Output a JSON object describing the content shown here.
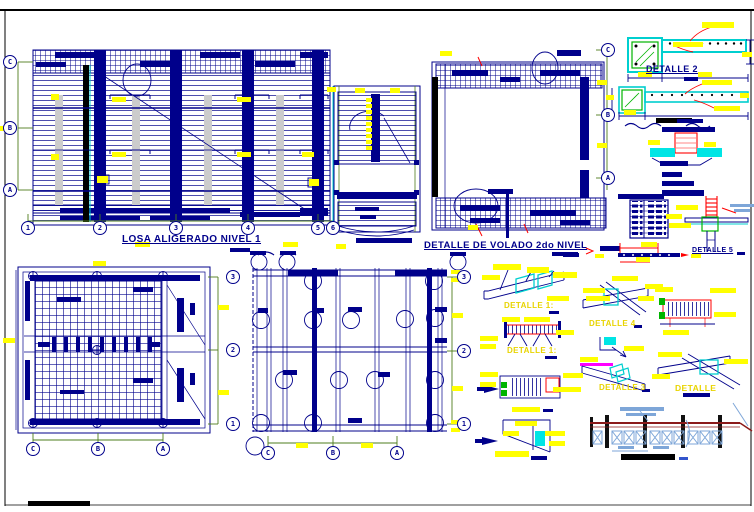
{
  "sheet": {
    "plans": {
      "losa": {
        "title": "LOSA ALIGERADO NIVEL 1",
        "row_bubbles": [
          "C",
          "B",
          "A"
        ],
        "col_bubbles": [
          "1",
          "2",
          "3",
          "4",
          "5",
          "6"
        ]
      },
      "volado": {
        "title": "DETALLE DE VOLADO 2do NIVEL",
        "row_bubbles": [
          "C",
          "B",
          "A"
        ]
      },
      "mesh": {
        "col_bubbles": [
          "C",
          "B",
          "A"
        ],
        "row_bubbles": [
          "3",
          "2",
          "1"
        ]
      },
      "beams": {
        "col_bubbles": [
          "C",
          "B",
          "A"
        ],
        "row_bubbles": [
          "3",
          "2",
          "1"
        ]
      }
    },
    "details": {
      "d2": {
        "title": "DETALLE 2"
      },
      "iso1": {
        "title": "DETALLE 1:"
      },
      "elev1": {
        "title": "DETALLE 1:"
      },
      "iso4": {
        "title": "DETALLE 4"
      },
      "iso3": {
        "title": "DETALLE 3"
      },
      "iso6": {
        "title": "DETALLE"
      },
      "col5": {
        "title": "DETALLE 5"
      }
    },
    "colors": {
      "linework_navy": "#00008B",
      "highlight_yellow": "#FFFF00",
      "slab_cyan": "#00FFFF",
      "section_green": "#00B400",
      "marker_red": "#FF0000",
      "marker_magenta": "#FF00FF",
      "rail_dark_red": "#8B1A1A",
      "rail_light_blue": "#7EA6D8",
      "shade_gray": "#CCCCCC",
      "dimension_green": "#4E7C1C",
      "frame_black": "#000000"
    }
  }
}
